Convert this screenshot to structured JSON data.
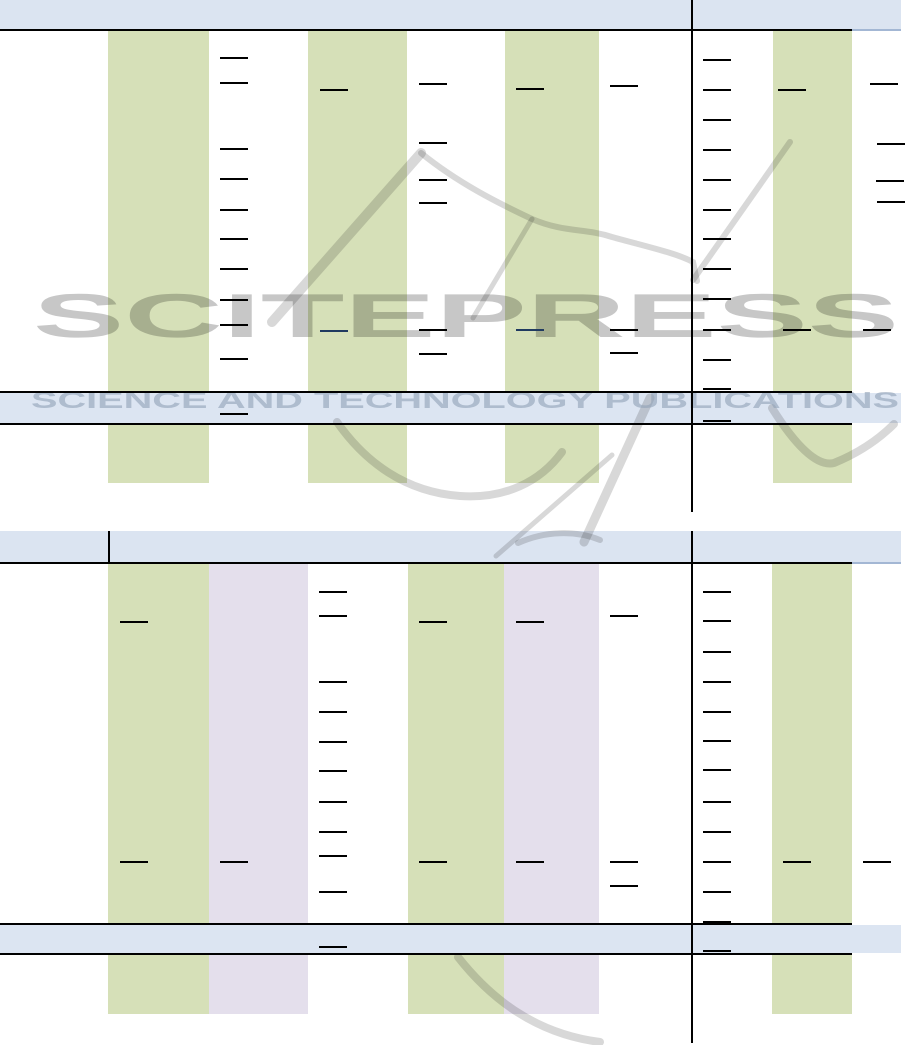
{
  "page": {
    "width": 917,
    "height": 1045,
    "background": "#ffffff"
  },
  "watermark": {
    "title": "SCITEPRESS",
    "subtitle": "SCIENCE AND TECHNOLOGY PUBLICATIONS"
  },
  "colors": {
    "header_blue": "#dbe4f1",
    "row_blue": "#dce5f2",
    "green": "#d6e0b8",
    "lavender": "#e4dfec",
    "line": "#000000",
    "thin_line": "#a3b7d4",
    "dash": "#000000",
    "navy": "#203a60",
    "watermark_gray": "#c7c7c7",
    "watermark_subtitle_gray": "#8fa0b6"
  },
  "tables": [
    {
      "name": "results-table-top",
      "header": {
        "x": 0,
        "y": 0,
        "w": 901,
        "h": 29,
        "underline": {
          "x": 0,
          "y": 28.5,
          "w": 852,
          "h": 2.5
        },
        "thin_underline": {
          "x": 852,
          "y": 29,
          "w": 49,
          "h": 1.5
        },
        "dividers": []
      },
      "body": {
        "y": 31,
        "h": 452
      },
      "bands": [
        {
          "x": 108,
          "w": 101,
          "color": "green"
        },
        {
          "x": 308,
          "w": 99,
          "color": "green"
        },
        {
          "x": 505,
          "w": 94,
          "color": "green"
        },
        {
          "x": 773,
          "w": 79,
          "color": "green"
        }
      ],
      "vdividers": [
        {
          "x": 690.5,
          "y": 0,
          "w": 2,
          "h": 512
        }
      ],
      "highlight_row": {
        "fill_x": 0,
        "fill_w": 901,
        "line_x": 0,
        "line_w": 852,
        "y": 390.5,
        "line_h": 2,
        "fill_h": 30
      },
      "dash": {
        "w": 28,
        "h": 2
      },
      "dashes": [
        [
          220,
          57
        ],
        [
          220,
          82
        ],
        [
          220,
          148
        ],
        [
          220,
          178
        ],
        [
          220,
          209
        ],
        [
          220,
          238
        ],
        [
          220,
          268
        ],
        [
          220,
          299
        ],
        [
          220,
          324
        ],
        [
          220,
          358
        ],
        [
          220,
          413
        ],
        [
          320,
          89
        ],
        [
          320,
          330,
          "navy"
        ],
        [
          419,
          83
        ],
        [
          419,
          142
        ],
        [
          419,
          179
        ],
        [
          419,
          202
        ],
        [
          419,
          329
        ],
        [
          419,
          353
        ],
        [
          516,
          88
        ],
        [
          516,
          329,
          "navy"
        ],
        [
          610,
          85
        ],
        [
          610,
          329
        ],
        [
          610,
          352
        ],
        [
          703,
          59
        ],
        [
          703,
          89
        ],
        [
          703,
          119
        ],
        [
          703,
          149
        ],
        [
          703,
          179
        ],
        [
          703,
          209
        ],
        [
          703,
          238
        ],
        [
          703,
          268
        ],
        [
          703,
          298
        ],
        [
          703,
          329
        ],
        [
          703,
          359
        ],
        [
          703,
          388
        ],
        [
          703,
          420
        ],
        [
          778,
          89
        ],
        [
          783,
          329
        ],
        [
          870,
          83
        ],
        [
          877,
          143
        ],
        [
          876,
          180
        ],
        [
          877,
          201
        ],
        [
          863,
          329
        ]
      ]
    },
    {
      "name": "results-table-bottom",
      "header": {
        "x": 0,
        "y": 531,
        "w": 901,
        "h": 31,
        "underline": {
          "x": 0,
          "y": 561.5,
          "w": 852,
          "h": 2.5
        },
        "thin_underline": {
          "x": 852,
          "y": 562,
          "w": 49,
          "h": 1.5
        },
        "dividers": [
          {
            "x": 107.5,
            "y": 531,
            "w": 2,
            "h": 31
          }
        ]
      },
      "body": {
        "y": 564,
        "h": 450
      },
      "bands": [
        {
          "x": 108,
          "w": 101,
          "color": "green"
        },
        {
          "x": 209,
          "w": 99,
          "color": "lavender"
        },
        {
          "x": 408,
          "w": 96,
          "color": "green"
        },
        {
          "x": 504,
          "w": 95,
          "color": "lavender"
        },
        {
          "x": 772,
          "w": 80,
          "color": "green"
        }
      ],
      "vdividers": [
        {
          "x": 690.5,
          "y": 531,
          "w": 2,
          "h": 512
        }
      ],
      "highlight_row": {
        "fill_x": 0,
        "fill_w": 901,
        "line_x": 0,
        "line_w": 852,
        "y": 922.5,
        "line_h": 2,
        "fill_h": 28
      },
      "dash": {
        "w": 28,
        "h": 2
      },
      "dashes": [
        [
          120,
          621
        ],
        [
          120,
          861
        ],
        [
          220,
          861
        ],
        [
          319,
          591
        ],
        [
          319,
          615
        ],
        [
          319,
          681
        ],
        [
          319,
          711
        ],
        [
          319,
          741
        ],
        [
          319,
          770
        ],
        [
          319,
          801
        ],
        [
          319,
          831
        ],
        [
          319,
          855
        ],
        [
          319,
          891
        ],
        [
          319,
          946
        ],
        [
          419,
          621
        ],
        [
          419,
          861
        ],
        [
          516,
          621
        ],
        [
          516,
          861
        ],
        [
          610,
          615
        ],
        [
          610,
          861
        ],
        [
          610,
          885
        ],
        [
          703,
          591
        ],
        [
          703,
          620
        ],
        [
          703,
          651
        ],
        [
          703,
          681
        ],
        [
          703,
          711
        ],
        [
          703,
          740
        ],
        [
          703,
          769
        ],
        [
          703,
          801
        ],
        [
          703,
          831
        ],
        [
          703,
          861
        ],
        [
          703,
          891
        ],
        [
          703,
          921
        ],
        [
          703,
          950
        ],
        [
          783,
          861
        ],
        [
          863,
          861
        ]
      ]
    }
  ]
}
